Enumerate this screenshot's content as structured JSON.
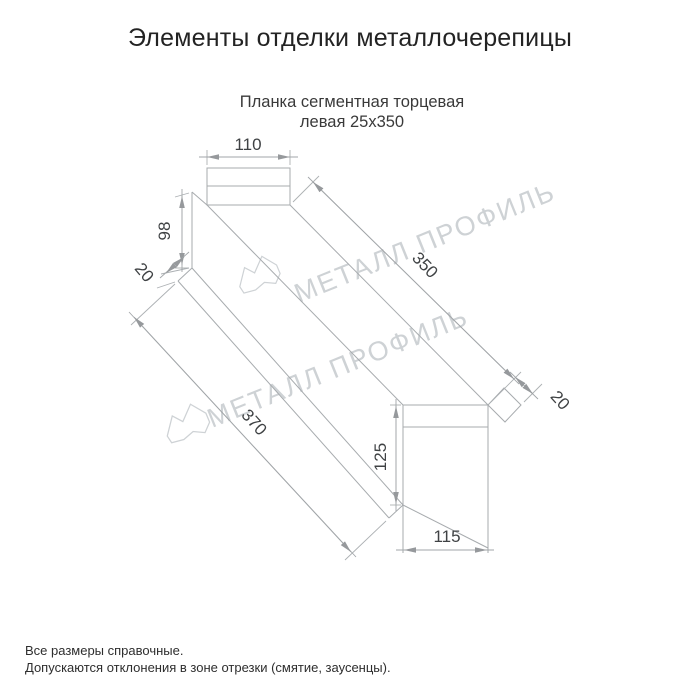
{
  "window": {
    "title": "Элементы отделки металлочерепицы"
  },
  "product": {
    "subtitle_line1": "Планка сегментная торцевая",
    "subtitle_line2": "левая 25х350"
  },
  "dimensions": {
    "top_face_width": "110",
    "left_end_height": "98",
    "left_fold": "20",
    "top_edge_length": "350",
    "right_fold": "20",
    "bottom_edge_length": "370",
    "right_end_height": "125",
    "bottom_face_width": "115"
  },
  "watermark": {
    "brand": "МЕТАЛЛ ПРОФИЛЬ"
  },
  "footer": {
    "note1": "Все размеры справочные.",
    "note2": "Допускаются отклонения в зоне отрезки (смятие, заусенцы)."
  },
  "colors": {
    "line": "#a7abae",
    "dim_text": "#3f4244",
    "watermark": "#ced2d5",
    "title_text": "#232323"
  }
}
